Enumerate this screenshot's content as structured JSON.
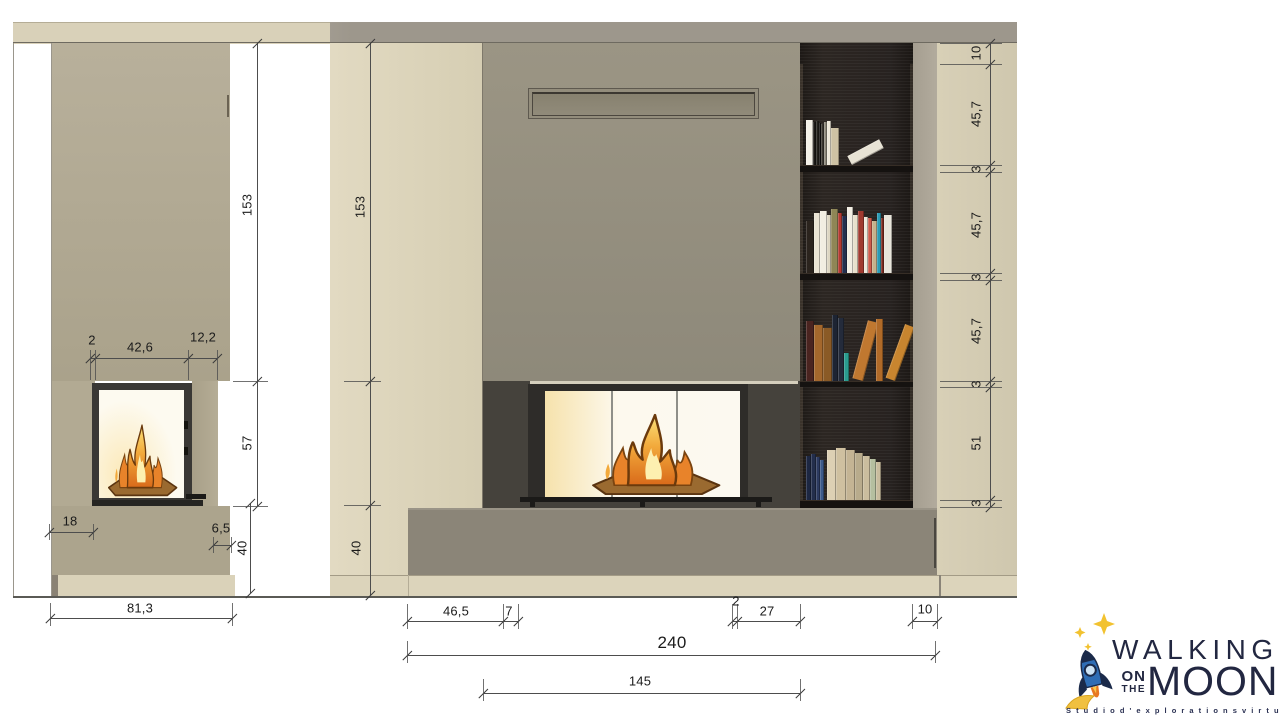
{
  "drawing_title": "fireplace-wall-elevations",
  "palette": {
    "ceiling_left": "#d9d1b9",
    "ceiling_right": "#9d978c",
    "wall_taupe_top": "#b8b09b",
    "wall_taupe_bottom": "#aaa28b",
    "wall_beige_light": "#e0d8c0",
    "wall_beige_dark": "#d5cdb2",
    "panel_gray_top": "#9b9584",
    "panel_gray_bottom": "#8e897a",
    "surround_dark": "#45423c",
    "frame_dark": "#2e2c29",
    "bench_gray": "#8b8578",
    "plinth_beige": "#dcd4bb",
    "bookshelf_dark": "#272220",
    "side_strip": "#b2ab9d",
    "right_column_beige": "#d6ceb5",
    "glass_glow_warm": "#f6e2ac",
    "glass_glow_white": "#fdf9ee",
    "dim_line": "#4d4d4d",
    "dim_text": "#1b1b1b",
    "logo_navy": "#222741",
    "rocket_blue": "#2f6db5",
    "star_yellow": "#f2c230",
    "flame_orange": "#e8832a"
  },
  "dims": {
    "h_lines": [
      {
        "x1": 90,
        "x2": 217,
        "y": 358,
        "ticks": [
          90,
          95,
          188,
          217
        ]
      },
      {
        "x1": 49,
        "x2": 93,
        "y": 532,
        "ticks": [
          49,
          93
        ]
      },
      {
        "x1": 213,
        "x2": 231,
        "y": 545,
        "ticks": [
          213,
          231
        ]
      },
      {
        "x1": 50,
        "x2": 232,
        "y": 618,
        "ticks": [
          50,
          232
        ]
      },
      {
        "x1": 407,
        "x2": 518,
        "y": 621,
        "ticks": [
          407,
          503,
          518
        ]
      },
      {
        "x1": 732,
        "x2": 800,
        "y": 621,
        "ticks": [
          732,
          737,
          800
        ]
      },
      {
        "x1": 912,
        "x2": 937,
        "y": 621,
        "ticks": [
          912,
          937
        ]
      },
      {
        "x1": 407,
        "x2": 935,
        "y": 655,
        "ticks": [
          407,
          935
        ]
      },
      {
        "x1": 483,
        "x2": 800,
        "y": 693,
        "ticks": [
          483,
          800
        ]
      }
    ],
    "v_lines": [
      {
        "x": 257,
        "y1": 43,
        "y2": 506,
        "ticks": [
          43,
          381,
          506
        ]
      },
      {
        "x": 250,
        "y1": 503,
        "y2": 593,
        "ticks": [
          503,
          593
        ]
      },
      {
        "x": 370,
        "y1": 43,
        "y2": 595,
        "ticks": [
          43,
          381,
          505,
          595
        ]
      },
      {
        "x": 990,
        "y1": 43,
        "y2": 507,
        "ticks": [
          43,
          64,
          165,
          172,
          273,
          280,
          381,
          387,
          500,
          507
        ]
      }
    ],
    "guides": [
      {
        "x": 90,
        "y1": 350,
        "y2": 380
      },
      {
        "x": 95,
        "y1": 350,
        "y2": 380
      },
      {
        "x": 188,
        "y1": 350,
        "y2": 380
      },
      {
        "x": 217,
        "y1": 350,
        "y2": 380
      },
      {
        "x": 49,
        "y1": 524,
        "y2": 540
      },
      {
        "x": 93,
        "y1": 524,
        "y2": 540
      },
      {
        "x": 213,
        "y1": 537,
        "y2": 553
      },
      {
        "x": 231,
        "y1": 537,
        "y2": 553
      },
      {
        "x": 50,
        "y1": 603,
        "y2": 626
      },
      {
        "x": 232,
        "y1": 603,
        "y2": 626
      },
      {
        "x": 407,
        "y1": 604,
        "y2": 629
      },
      {
        "x": 503,
        "y1": 604,
        "y2": 629
      },
      {
        "x": 518,
        "y1": 604,
        "y2": 629
      },
      {
        "x": 732,
        "y1": 604,
        "y2": 629
      },
      {
        "x": 737,
        "y1": 604,
        "y2": 629
      },
      {
        "x": 800,
        "y1": 604,
        "y2": 629
      },
      {
        "x": 912,
        "y1": 604,
        "y2": 629
      },
      {
        "x": 937,
        "y1": 604,
        "y2": 629
      },
      {
        "x": 407,
        "y1": 641,
        "y2": 663
      },
      {
        "x": 935,
        "y1": 641,
        "y2": 663
      },
      {
        "x": 483,
        "y1": 679,
        "y2": 701
      },
      {
        "x": 800,
        "y1": 679,
        "y2": 701
      },
      {
        "y": 381,
        "x1": 233,
        "x2": 268
      },
      {
        "y": 506,
        "x1": 233,
        "x2": 268
      },
      {
        "y": 381,
        "x1": 344,
        "x2": 381
      },
      {
        "y": 505,
        "x1": 344,
        "x2": 381
      },
      {
        "y": 43,
        "x1": 940,
        "x2": 1002
      },
      {
        "y": 64,
        "x1": 940,
        "x2": 1002
      },
      {
        "y": 165,
        "x1": 940,
        "x2": 1002
      },
      {
        "y": 172,
        "x1": 940,
        "x2": 1002
      },
      {
        "y": 273,
        "x1": 940,
        "x2": 1002
      },
      {
        "y": 280,
        "x1": 940,
        "x2": 1002
      },
      {
        "y": 381,
        "x1": 940,
        "x2": 1002
      },
      {
        "y": 387,
        "x1": 940,
        "x2": 1002
      },
      {
        "y": 500,
        "x1": 940,
        "x2": 1002
      },
      {
        "y": 507,
        "x1": 940,
        "x2": 1002
      }
    ],
    "labels": [
      {
        "t": "153",
        "x": 247,
        "y": 205,
        "rot": true
      },
      {
        "t": "57",
        "x": 247,
        "y": 443,
        "rot": true
      },
      {
        "t": "2",
        "x": 92,
        "y": 340
      },
      {
        "t": "42,6",
        "x": 140,
        "y": 347
      },
      {
        "t": "12,2",
        "x": 203,
        "y": 337
      },
      {
        "t": "18",
        "x": 70,
        "y": 521
      },
      {
        "t": "6,5",
        "x": 221,
        "y": 528
      },
      {
        "t": "40",
        "x": 242,
        "y": 548,
        "rot": true
      },
      {
        "t": "81,3",
        "x": 140,
        "y": 608
      },
      {
        "t": "153",
        "x": 360,
        "y": 207,
        "rot": true
      },
      {
        "t": "40",
        "x": 356,
        "y": 548,
        "rot": true
      },
      {
        "t": "46,5",
        "x": 456,
        "y": 611
      },
      {
        "t": "7",
        "x": 509,
        "y": 611
      },
      {
        "t": "2",
        "x": 736,
        "y": 601
      },
      {
        "t": "27",
        "x": 767,
        "y": 611
      },
      {
        "t": "10",
        "x": 925,
        "y": 609
      },
      {
        "t": "240",
        "x": 672,
        "y": 643,
        "big": true
      },
      {
        "t": "145",
        "x": 640,
        "y": 681
      },
      {
        "t": "10",
        "x": 976,
        "y": 53,
        "rot": true
      },
      {
        "t": "45,7",
        "x": 976,
        "y": 114,
        "rot": true
      },
      {
        "t": "3",
        "x": 976,
        "y": 169,
        "rot": true
      },
      {
        "t": "45,7",
        "x": 976,
        "y": 225,
        "rot": true
      },
      {
        "t": "3",
        "x": 976,
        "y": 277,
        "rot": true
      },
      {
        "t": "45,7",
        "x": 976,
        "y": 331,
        "rot": true
      },
      {
        "t": "3",
        "x": 976,
        "y": 384,
        "rot": true
      },
      {
        "t": "51",
        "x": 976,
        "y": 443,
        "rot": true
      },
      {
        "t": "3",
        "x": 976,
        "y": 503,
        "rot": true
      }
    ]
  },
  "bookshelf": {
    "books_x0": 806,
    "shelves": [
      {
        "bottom": 165,
        "books": [
          {
            "w": 7,
            "h": 45,
            "c": "#f4f1e8"
          },
          {
            "w": 3,
            "h": 43,
            "c": "#1b1916"
          },
          {
            "w": 3,
            "h": 44,
            "c": "#23211d"
          },
          {
            "w": 2,
            "h": 42,
            "c": "#141210"
          },
          {
            "w": 3,
            "h": 41,
            "c": "#3a362f"
          },
          {
            "w": 3,
            "h": 43,
            "c": "#8d887a"
          },
          {
            "w": 4,
            "h": 44,
            "c": "#efeadb"
          },
          {
            "w": 8,
            "h": 37,
            "c": "#cec2a4"
          },
          {
            "gap": 3,
            "w": 10,
            "h": 36,
            "c": "#e8e3d5",
            "lean": 62,
            "adv": 30
          }
        ]
      },
      {
        "bottom": 273,
        "books": [
          {
            "w": 8,
            "h": 52,
            "c": "#2b241e"
          },
          {
            "w": 6,
            "h": 60,
            "c": "#eae4d4"
          },
          {
            "w": 7,
            "h": 62,
            "c": "#f2eee2"
          },
          {
            "w": 4,
            "h": 58,
            "c": "#ddd6c2"
          },
          {
            "w": 7,
            "h": 64,
            "c": "#8f8656"
          },
          {
            "w": 4,
            "h": 60,
            "c": "#b43a32"
          },
          {
            "w": 5,
            "h": 57,
            "c": "#232f4e"
          },
          {
            "w": 6,
            "h": 66,
            "c": "#f3efe4"
          },
          {
            "w": 5,
            "h": 58,
            "c": "#e8e1cd"
          },
          {
            "w": 6,
            "h": 62,
            "c": "#a03a30"
          },
          {
            "w": 4,
            "h": 56,
            "c": "#eee9dc"
          },
          {
            "w": 4,
            "h": 55,
            "c": "#cd5b4c"
          },
          {
            "w": 5,
            "h": 52,
            "c": "#c6b28c"
          },
          {
            "w": 4,
            "h": 60,
            "c": "#2a9bb5"
          },
          {
            "w": 3,
            "h": 55,
            "c": "#7c2c22"
          },
          {
            "w": 8,
            "h": 58,
            "c": "#e9e6dc"
          }
        ]
      },
      {
        "bottom": 381,
        "books": [
          {
            "w": 8,
            "h": 60,
            "c": "#4a2420"
          },
          {
            "w": 9,
            "h": 56,
            "c": "#a4672c"
          },
          {
            "w": 9,
            "h": 53,
            "c": "#8a5a26"
          },
          {
            "w": 6,
            "h": 66,
            "c": "#1d2433"
          },
          {
            "w": 6,
            "h": 63,
            "c": "#242b3b"
          },
          {
            "w": 5,
            "h": 28,
            "c": "#2a9b8f"
          },
          {
            "gap": 3,
            "w": 11,
            "h": 60,
            "c": "#c07830",
            "lean": 15,
            "adv": 24
          },
          {
            "w": 7,
            "h": 62,
            "c": "#b06a28"
          },
          {
            "gap": 2,
            "w": 10,
            "h": 57,
            "c": "#c8852f",
            "lean": 20,
            "adv": 22
          }
        ]
      },
      {
        "bottom": 500,
        "books": [
          {
            "w": 5,
            "h": 44,
            "c": "#1d2742"
          },
          {
            "w": 5,
            "h": 46,
            "c": "#232e4c"
          },
          {
            "w": 4,
            "h": 43,
            "c": "#2c3a60"
          },
          {
            "w": 4,
            "h": 40,
            "c": "#3d5a8a"
          },
          {
            "gap": 3,
            "w": 9,
            "h": 50,
            "c": "#ddd0b4"
          },
          {
            "w": 10,
            "h": 52,
            "c": "#cfc0a0"
          },
          {
            "w": 9,
            "h": 50,
            "c": "#c4b494"
          },
          {
            "w": 8,
            "h": 47,
            "c": "#b8ab8c"
          },
          {
            "w": 7,
            "h": 44,
            "c": "#cabd9e"
          },
          {
            "w": 6,
            "h": 41,
            "c": "#b5bfa0"
          },
          {
            "w": 5,
            "h": 38,
            "c": "#c9bc9e"
          }
        ]
      }
    ]
  },
  "logo": {
    "walking": "WALKING",
    "on": "ON",
    "the": "THE",
    "moon": "MOON",
    "tagline": "S t u d i o   d ' e x p l o r a t i o n s   v i r t u e l l e s   3 D"
  }
}
